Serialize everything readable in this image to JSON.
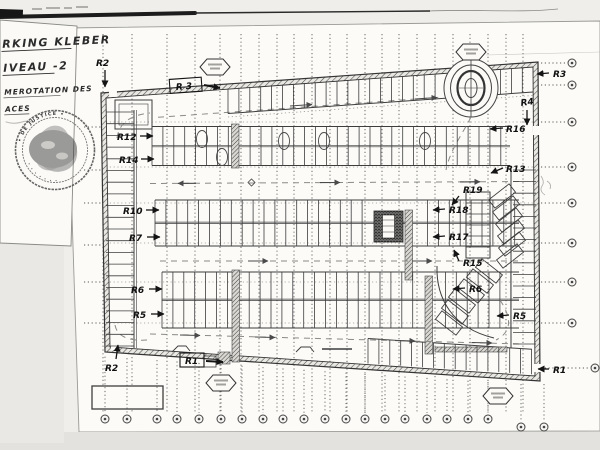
{
  "scan": {
    "paper_color": "#fbfaf7",
    "background_color": "#efeeea",
    "ink_color": "#2f2f2f"
  },
  "title_block": {
    "line1": "RKING KLEBER",
    "line2": "IVEAU -2",
    "line3": "MEROTATION DES",
    "line4": "ACES",
    "seal_top_text": "• DE JUSTICE •",
    "seal_bottom_text": "· · · · · · ·"
  },
  "plan": {
    "grid_vertical_x": [
      103,
      132,
      167,
      195,
      220,
      241,
      259,
      277,
      294,
      312,
      330,
      347,
      365,
      382,
      399,
      417,
      435,
      453,
      470,
      488,
      506,
      523
    ],
    "grid_inner_horizontal_y": [
      122,
      167,
      203,
      243,
      282,
      323
    ],
    "left_leader_y": [
      127,
      170,
      203,
      245,
      282,
      323
    ],
    "right_markers": [
      {
        "y": 63
      },
      {
        "y": 85
      },
      {
        "y": 122
      },
      {
        "y": 167
      },
      {
        "y": 203
      },
      {
        "y": 243
      },
      {
        "y": 282
      },
      {
        "y": 323
      },
      {
        "y": 368,
        "cx": 595
      }
    ],
    "bottom_markers_x": [
      105,
      127,
      157,
      177,
      199,
      221,
      242,
      263,
      283,
      304,
      325,
      346,
      365,
      385,
      405,
      427,
      447,
      468,
      488
    ],
    "bottom_markers_y": 419,
    "bottom_markers_extra": [
      [
        521,
        427
      ],
      [
        544,
        427
      ]
    ],
    "bubbles": [
      {
        "x": 215,
        "y": 67
      },
      {
        "x": 471,
        "y": 52
      },
      {
        "x": 221,
        "y": 383
      },
      {
        "x": 498,
        "y": 396
      }
    ]
  },
  "annotations": [
    {
      "text": "R2",
      "x": 96,
      "y": 66,
      "arrow": [
        105,
        70,
        105,
        87
      ]
    },
    {
      "text": "R 3",
      "x": 176,
      "y": 90,
      "rot": -4,
      "box": [
        170,
        79,
        32,
        14
      ],
      "arrow": [
        204,
        85,
        220,
        88
      ],
      "aw": 2
    },
    {
      "text": "R3",
      "x": 553,
      "y": 77,
      "arrow": [
        549,
        73,
        537,
        74
      ]
    },
    {
      "text": "R4",
      "x": 521,
      "y": 106,
      "rot": -8,
      "arrow": [
        527,
        110,
        527,
        125
      ]
    },
    {
      "text": "R16",
      "x": 506,
      "y": 132,
      "arrow": [
        503,
        128,
        490,
        129
      ]
    },
    {
      "text": "R13",
      "x": 506,
      "y": 172,
      "arrow": [
        503,
        168,
        491,
        173
      ]
    },
    {
      "text": "R12",
      "x": 117,
      "y": 140,
      "arrow": [
        140,
        136,
        153,
        136
      ]
    },
    {
      "text": "R14",
      "x": 119,
      "y": 163,
      "arrow": [
        141,
        159,
        154,
        159
      ]
    },
    {
      "text": "R10",
      "x": 123,
      "y": 214,
      "arrow": [
        146,
        210,
        159,
        210
      ]
    },
    {
      "text": "R7",
      "x": 129,
      "y": 241,
      "arrow": [
        147,
        237,
        160,
        237
      ]
    },
    {
      "text": "R6",
      "x": 131,
      "y": 293,
      "arrow": [
        149,
        289,
        162,
        289
      ]
    },
    {
      "text": "R5",
      "x": 133,
      "y": 318,
      "arrow": [
        151,
        314,
        164,
        314
      ]
    },
    {
      "text": "R2",
      "x": 105,
      "y": 371,
      "arrow": [
        116,
        359,
        118,
        345
      ]
    },
    {
      "text": "R1",
      "x": 185,
      "y": 364,
      "box": [
        180,
        353,
        24,
        14
      ],
      "arrow": [
        206,
        361,
        223,
        362
      ],
      "aw": 2
    },
    {
      "text": "R1",
      "x": 553,
      "y": 373,
      "arrow": [
        549,
        369,
        538,
        369
      ]
    },
    {
      "text": "R19",
      "x": 463,
      "y": 193,
      "arrow": [
        459,
        196,
        452,
        205
      ]
    },
    {
      "text": "R18",
      "x": 449,
      "y": 213,
      "arrow": [
        445,
        209,
        433,
        210
      ]
    },
    {
      "text": "R17",
      "x": 449,
      "y": 240,
      "arrow": [
        445,
        236,
        433,
        237
      ]
    },
    {
      "text": "R15",
      "x": 463,
      "y": 266,
      "arrow": [
        459,
        261,
        454,
        250
      ]
    },
    {
      "text": "R6",
      "x": 469,
      "y": 292,
      "arrow": [
        465,
        288,
        453,
        289
      ]
    },
    {
      "text": "R5",
      "x": 513,
      "y": 319,
      "arrow": [
        509,
        315,
        497,
        316
      ]
    }
  ]
}
